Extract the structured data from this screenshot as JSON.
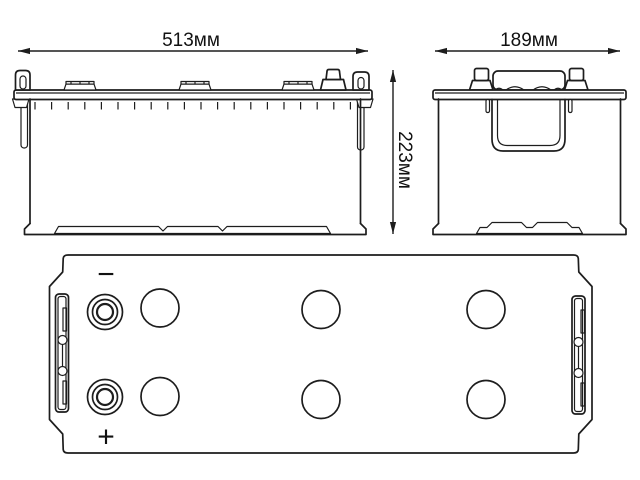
{
  "colors": {
    "background": "#ffffff",
    "line": "#1d1d1d",
    "text": "#111111"
  },
  "views": {
    "front": {
      "width_label": "513мм"
    },
    "side": {
      "width_label": "189мм",
      "height_label": "223мм"
    },
    "top": {
      "negative_sign": "−",
      "positive_sign": "+"
    }
  }
}
